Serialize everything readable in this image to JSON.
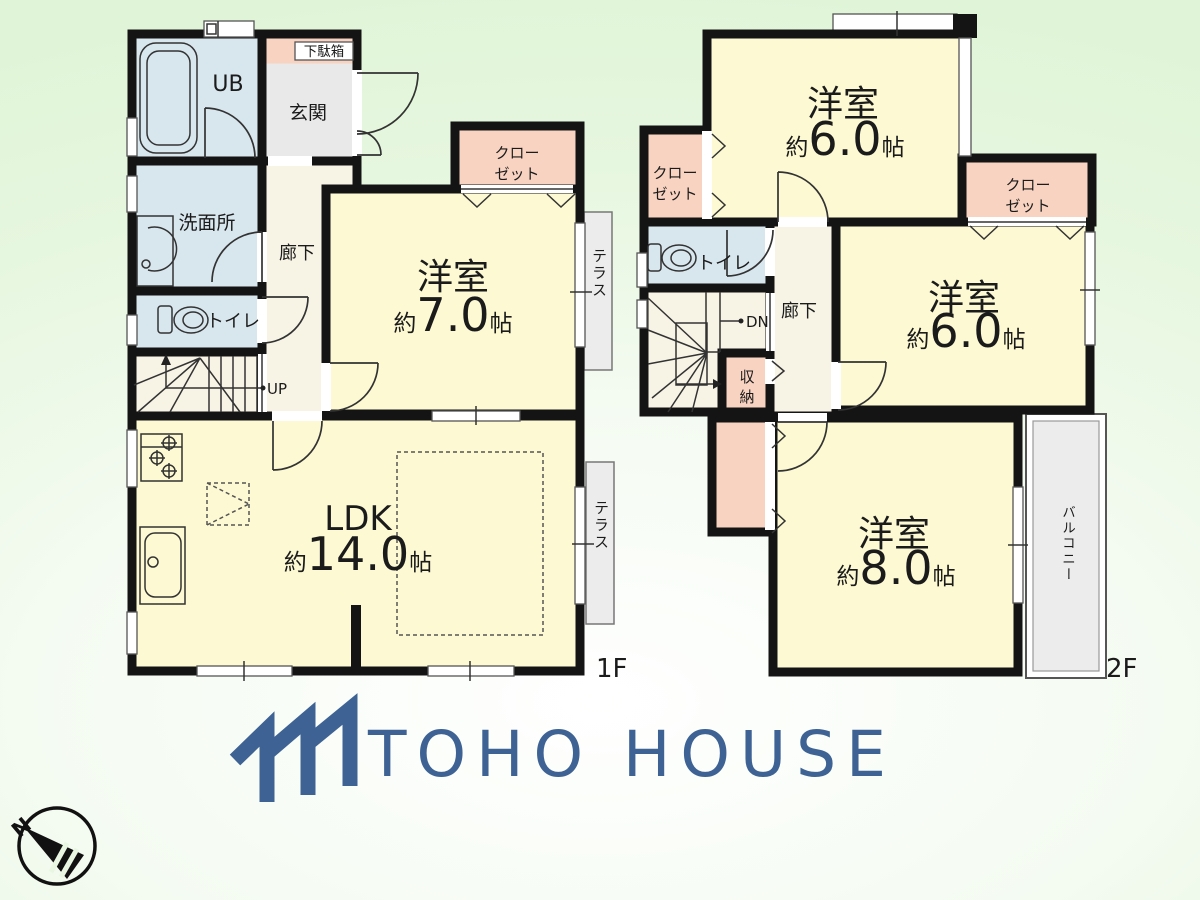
{
  "palette": {
    "room_yellow": "#fcf9d3",
    "water_blue": "#d8e6ee",
    "closet_pink": "#f8d3c1",
    "hallway_cream": "#f7f4e6",
    "entry_gray": "#e9e9e9",
    "terrace_gray": "#ececec",
    "wall_black": "#141414",
    "brand_blue": "#3d6293",
    "background_green": "#e4f6dd"
  },
  "floor1": {
    "label": "1F",
    "rooms": {
      "ub": "UB",
      "shoe_cabinet": "下駄箱",
      "entrance": "玄関",
      "washroom": "洗面所",
      "toilet": "トイレ",
      "hallway": "廊下",
      "closet_line1": "クロー",
      "closet_line2": "ゼット",
      "western_room": {
        "name": "洋室",
        "approx": "約",
        "size": "7.0",
        "unit": "帖"
      },
      "ldk": {
        "name": "LDK",
        "approx": "約",
        "size": "14.0",
        "unit": "帖"
      },
      "terrace": "テラス",
      "stairs": "UP"
    }
  },
  "floor2": {
    "label": "2F",
    "rooms": {
      "closet_line1": "クロー",
      "closet_line2": "ゼット",
      "toilet": "トイレ",
      "hallway": "廊下",
      "stairs": "DN",
      "storage_line1": "収",
      "storage_line2": "納",
      "room_top": {
        "name": "洋室",
        "approx": "約",
        "size": "6.0",
        "unit": "帖"
      },
      "room_mid": {
        "name": "洋室",
        "approx": "約",
        "size": "6.0",
        "unit": "帖"
      },
      "room_bottom": {
        "name": "洋室",
        "approx": "約",
        "size": "8.0",
        "unit": "帖"
      },
      "balcony": "バルコニー"
    }
  },
  "brand": {
    "name": "TOHO HOUSE"
  },
  "compass": {
    "north": "N"
  }
}
